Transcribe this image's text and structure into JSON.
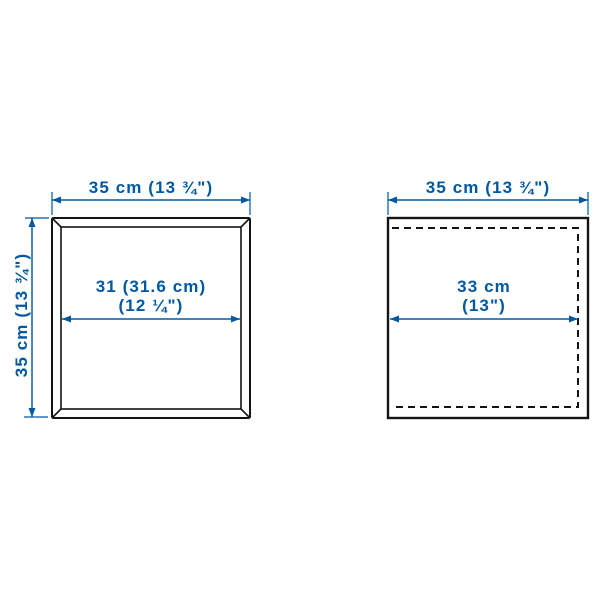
{
  "figure": {
    "type": "product-dimension-diagram",
    "colors": {
      "dimension_blue": "#0058a3",
      "outline_black": "#141414",
      "background": "#ffffff"
    },
    "left_view": {
      "description": "front view of framed square panel with beveled edges",
      "top_width_label": "35 cm (13 ¾\")",
      "side_height_label": "35 cm (13 ¾\")",
      "inner_width_line1": "31 (31.6 cm)",
      "inner_width_line2": "(12 ¼\")"
    },
    "right_view": {
      "description": "square outline with dashed interior boundary",
      "top_width_label": "35 cm (13 ¾\")",
      "inner_width_line1": "33 cm",
      "inner_width_line2": "(13\")"
    }
  }
}
